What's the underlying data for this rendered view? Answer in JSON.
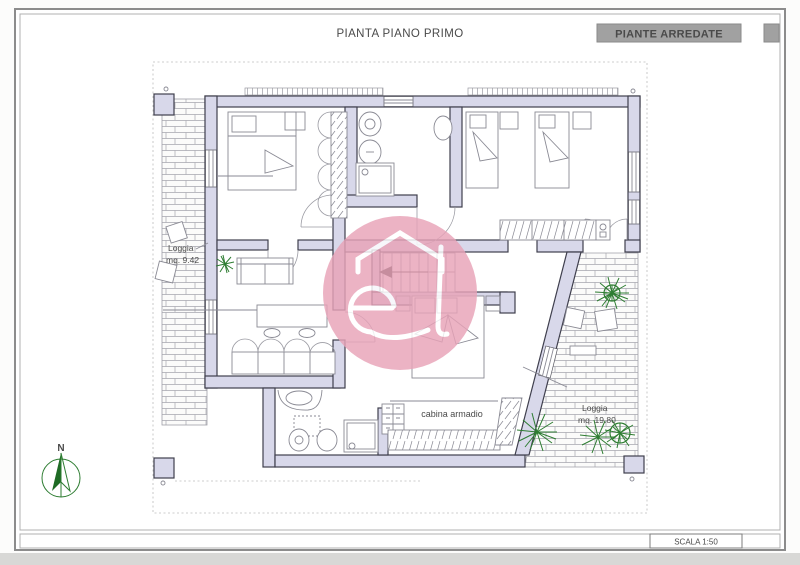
{
  "page": {
    "title": "PIANTA PIANO PRIMO",
    "badge": "PIANTE ARREDATE",
    "scale_label": "SCALA 1:50"
  },
  "plan": {
    "loggia_left": {
      "name": "Loggia",
      "area": "mq. 9.42"
    },
    "loggia_right": {
      "name": "Loggia",
      "area": "mq. 19.80"
    },
    "closet_label": "cabina armadio",
    "north_label": "N"
  },
  "icons": {
    "north_arrow": "compass-north-arrow",
    "logo": "agency-watermark-logo"
  },
  "colors": {
    "wall_fill": "#d8d8ea",
    "wall_stroke": "#3f3f4d",
    "badge_bg": "#a1a1a1",
    "badge_text": "#474747",
    "logo_pink": "#e8a3b8",
    "plant_green": "#2e7d32",
    "drawing_gray": "#8a8a94"
  }
}
